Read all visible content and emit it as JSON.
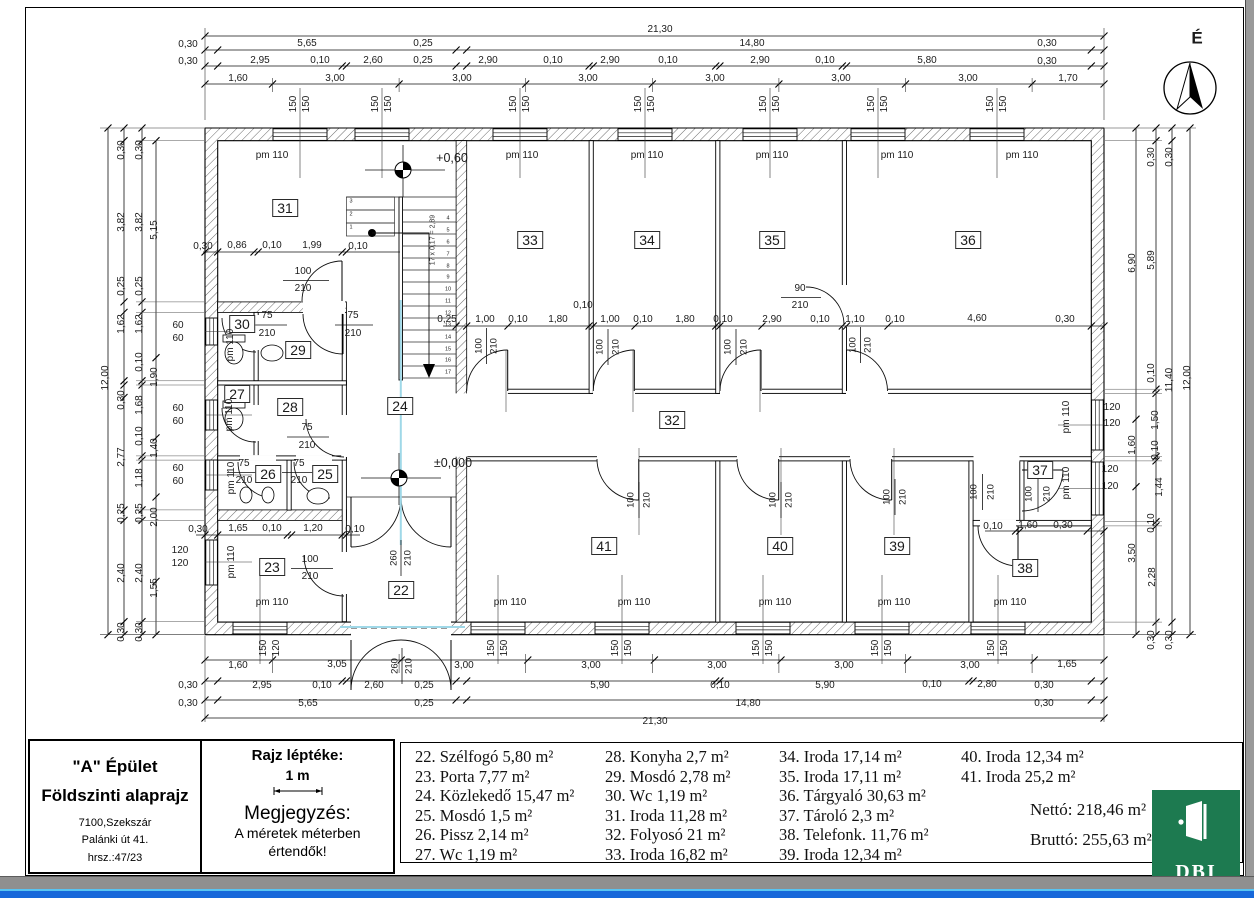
{
  "title_block": {
    "building": "\"A\" Épület",
    "drawing": "Földszinti alaprajz",
    "address_line1": "7100,Szekszár",
    "address_line2": "Palánki út 41.",
    "address_line3": "hrsz.:47/23"
  },
  "scale_block": {
    "label": "Rajz léptéke:",
    "scale": "1 m",
    "note_title": "Megjegyzés:",
    "note_line1": "A méretek méterben",
    "note_line2": "értendők!"
  },
  "legend": {
    "columns": [
      [
        "22. Szélfogó 5,80 m²",
        "23. Porta 7,77 m²",
        "24. Közlekedő 15,47 m²",
        "25. Mosdó 1,5 m²",
        "26. Pissz 2,14 m²",
        "27. Wc 1,19 m²"
      ],
      [
        "28. Konyha 2,7 m²",
        "29. Mosdó 2,78 m²",
        "30. Wc 1,19 m²",
        "31. Iroda 11,28 m²",
        "32. Folyosó 21 m²",
        "33. Iroda 16,82 m²"
      ],
      [
        "34. Iroda 17,14 m²",
        "35. Iroda 17,11 m²",
        "36. Tárgyaló 30,63 m²",
        "37. Tároló 2,3 m²",
        "38. Telefonk. 11,76 m²",
        "39. Iroda 12,34 m²"
      ],
      [
        "40. Iroda 12,34 m²",
        "41. Iroda 25,2 m²"
      ]
    ]
  },
  "totals": {
    "net": "Nettó: 218,46 m²",
    "gross": "Bruttó: 255,63 m²"
  },
  "logo": {
    "text": "DBI"
  },
  "compass": {
    "label": "É"
  },
  "plan": {
    "rooms": [
      [
        "22",
        401,
        590
      ],
      [
        "23",
        272,
        567
      ],
      [
        "24",
        400,
        406
      ],
      [
        "25",
        325,
        474
      ],
      [
        "26",
        268,
        474
      ],
      [
        "27",
        237,
        394
      ],
      [
        "28",
        290,
        407
      ],
      [
        "29",
        298,
        350
      ],
      [
        "30",
        242,
        324
      ],
      [
        "31",
        285,
        208
      ],
      [
        "32",
        672,
        420
      ],
      [
        "33",
        530,
        240
      ],
      [
        "34",
        647,
        240
      ],
      [
        "35",
        772,
        240
      ],
      [
        "36",
        968,
        240
      ],
      [
        "37",
        1040,
        470
      ],
      [
        "38",
        1025,
        568
      ],
      [
        "39",
        897,
        546
      ],
      [
        "40",
        780,
        546
      ],
      [
        "41",
        604,
        546
      ]
    ],
    "pm_h": [
      [
        "pm 110",
        272,
        156
      ],
      [
        "pm 110",
        522,
        156
      ],
      [
        "pm 110",
        647,
        156
      ],
      [
        "pm 110",
        772,
        156
      ],
      [
        "pm 110",
        897,
        156
      ],
      [
        "pm 110",
        1022,
        156
      ],
      [
        "pm 110",
        272,
        603
      ],
      [
        "pm 110",
        510,
        603
      ],
      [
        "pm 110",
        634,
        603
      ],
      [
        "pm 110",
        775,
        603
      ],
      [
        "pm 110",
        894,
        603
      ],
      [
        "pm 110",
        1010,
        603
      ]
    ],
    "pm_v": [
      [
        "pm 110",
        231,
        345
      ],
      [
        "pm 110",
        230,
        415
      ],
      [
        "pm 110",
        232,
        478
      ],
      [
        "pm 110",
        232,
        562
      ],
      [
        "pm 110",
        1067,
        417
      ],
      [
        "pm 110",
        1067,
        483
      ]
    ],
    "levels": [
      [
        "+0,60",
        452,
        158
      ],
      [
        "±0,000",
        453,
        463
      ]
    ],
    "stair_note": [
      [
        "17 x 0,17 = 2,89",
        433,
        240
      ]
    ],
    "stair_numbers": [
      [
        "1",
        351,
        228
      ],
      [
        "2",
        351,
        215
      ],
      [
        "3",
        351,
        202
      ],
      [
        "4",
        448,
        219
      ],
      [
        "5",
        448,
        231
      ],
      [
        "6",
        448,
        243
      ],
      [
        "7",
        448,
        255
      ],
      [
        "8",
        448,
        267
      ],
      [
        "9",
        448,
        278
      ],
      [
        "10",
        448,
        290
      ],
      [
        "11",
        448,
        302
      ],
      [
        "12",
        448,
        314
      ],
      [
        "13",
        448,
        326
      ],
      [
        "14",
        448,
        338
      ],
      [
        "15",
        448,
        350
      ],
      [
        "16",
        448,
        361
      ],
      [
        "17",
        448,
        373
      ]
    ],
    "doors_h": [
      [
        "100",
        303,
        272
      ],
      [
        "210",
        303,
        289
      ],
      [
        "75",
        267,
        316
      ],
      [
        "210",
        267,
        334
      ],
      [
        "75",
        353,
        316
      ],
      [
        "210",
        353,
        334
      ],
      [
        "75",
        307,
        428
      ],
      [
        "210",
        307,
        446
      ],
      [
        "75",
        244,
        464
      ],
      [
        "210",
        244,
        481
      ],
      [
        "75",
        299,
        464
      ],
      [
        "210",
        299,
        481
      ],
      [
        "100",
        310,
        560
      ],
      [
        "210",
        310,
        577
      ],
      [
        "90",
        800,
        289
      ],
      [
        "210",
        800,
        306
      ]
    ],
    "doors_v": [
      [
        "100",
        479,
        346
      ],
      [
        "210",
        494,
        346
      ],
      [
        "100",
        600,
        347
      ],
      [
        "210",
        616,
        347
      ],
      [
        "100",
        728,
        347
      ],
      [
        "210",
        744,
        347
      ],
      [
        "100",
        853,
        345
      ],
      [
        "210",
        868,
        345
      ],
      [
        "100",
        631,
        500
      ],
      [
        "210",
        647,
        500
      ],
      [
        "100",
        773,
        500
      ],
      [
        "210",
        789,
        500
      ],
      [
        "100",
        887,
        497
      ],
      [
        "210",
        903,
        497
      ],
      [
        "100",
        974,
        492
      ],
      [
        "210",
        991,
        492
      ],
      [
        "100",
        1029,
        494
      ],
      [
        "210",
        1047,
        494
      ],
      [
        "260",
        394,
        558
      ],
      [
        "210",
        408,
        558
      ],
      [
        "260",
        395,
        666
      ],
      [
        "210",
        409,
        666
      ]
    ],
    "dims_h": [
      [
        "21,30",
        660,
        30
      ],
      [
        "0,30",
        188,
        45
      ],
      [
        "5,65",
        307,
        44
      ],
      [
        "0,25",
        423,
        44
      ],
      [
        "14,80",
        752,
        44
      ],
      [
        "0,30",
        1047,
        44
      ],
      [
        "0,30",
        188,
        62
      ],
      [
        "2,95",
        260,
        61
      ],
      [
        "0,10",
        320,
        61
      ],
      [
        "2,60",
        373,
        61
      ],
      [
        "0,25",
        423,
        61
      ],
      [
        "2,90",
        488,
        61
      ],
      [
        "0,10",
        553,
        61
      ],
      [
        "2,90",
        610,
        61
      ],
      [
        "0,10",
        668,
        61
      ],
      [
        "2,90",
        760,
        61
      ],
      [
        "0,10",
        825,
        61
      ],
      [
        "5,80",
        927,
        61
      ],
      [
        "0,30",
        1047,
        62
      ],
      [
        "1,60",
        238,
        79
      ],
      [
        "3,00",
        335,
        79
      ],
      [
        "3,00",
        462,
        79
      ],
      [
        "3,00",
        588,
        79
      ],
      [
        "3,00",
        715,
        79
      ],
      [
        "3,00",
        841,
        79
      ],
      [
        "3,00",
        968,
        79
      ],
      [
        "1,70",
        1068,
        79
      ],
      [
        "0,25",
        447,
        320
      ],
      [
        "1,00",
        485,
        320
      ],
      [
        "0,10",
        518,
        320
      ],
      [
        "1,80",
        558,
        320
      ],
      [
        "0,10",
        583,
        306
      ],
      [
        "1,00",
        610,
        320
      ],
      [
        "0,10",
        643,
        320
      ],
      [
        "1,80",
        685,
        320
      ],
      [
        "0,10",
        723,
        320
      ],
      [
        "2,90",
        772,
        320
      ],
      [
        "0,10",
        820,
        320
      ],
      [
        "1,10",
        855,
        320
      ],
      [
        "0,10",
        895,
        320
      ],
      [
        "4,60",
        977,
        319
      ],
      [
        "0,30",
        1065,
        320
      ],
      [
        "0,30",
        203,
        247
      ],
      [
        "0,86",
        237,
        246
      ],
      [
        "0,10",
        272,
        246
      ],
      [
        "1,99",
        312,
        246
      ],
      [
        "0,10",
        358,
        247
      ],
      [
        "0,30",
        198,
        530
      ],
      [
        "1,65",
        238,
        529
      ],
      [
        "0,10",
        272,
        529
      ],
      [
        "1,20",
        313,
        529
      ],
      [
        "0,10",
        355,
        530
      ],
      [
        "0,10",
        993,
        527
      ],
      [
        "1,60",
        1028,
        526
      ],
      [
        "0,30",
        1063,
        526
      ],
      [
        "60",
        178,
        326
      ],
      [
        "60",
        178,
        339
      ],
      [
        "60",
        178,
        409
      ],
      [
        "60",
        178,
        422
      ],
      [
        "60",
        178,
        469
      ],
      [
        "60",
        178,
        482
      ],
      [
        "120",
        180,
        551
      ],
      [
        "120",
        180,
        564
      ],
      [
        "120",
        1112,
        408
      ],
      [
        "120",
        1112,
        424
      ],
      [
        "120",
        1110,
        470
      ],
      [
        "120",
        1110,
        487
      ],
      [
        "1,60",
        238,
        666
      ],
      [
        "3,05",
        337,
        665
      ],
      [
        "3,00",
        464,
        666
      ],
      [
        "3,00",
        591,
        666
      ],
      [
        "3,00",
        717,
        666
      ],
      [
        "3,00",
        844,
        666
      ],
      [
        "3,00",
        970,
        666
      ],
      [
        "1,65",
        1067,
        665
      ],
      [
        "0,30",
        188,
        686
      ],
      [
        "2,95",
        262,
        686
      ],
      [
        "0,10",
        322,
        686
      ],
      [
        "2,60",
        374,
        686
      ],
      [
        "0,25",
        424,
        686
      ],
      [
        "5,90",
        600,
        686
      ],
      [
        "0,10",
        720,
        686
      ],
      [
        "5,90",
        825,
        686
      ],
      [
        "0,10",
        932,
        685
      ],
      [
        "2,80",
        987,
        685
      ],
      [
        "0,30",
        1044,
        686
      ],
      [
        "0,30",
        188,
        704
      ],
      [
        "5,65",
        308,
        704
      ],
      [
        "0,25",
        424,
        704
      ],
      [
        "14,80",
        748,
        704
      ],
      [
        "0,30",
        1044,
        704
      ],
      [
        "21,30",
        655,
        722
      ]
    ],
    "dims_v": [
      [
        "12,00",
        106,
        378
      ],
      [
        "0,30",
        122,
        150
      ],
      [
        "3,82",
        122,
        222
      ],
      [
        "0,25",
        122,
        286
      ],
      [
        "1,62",
        122,
        324
      ],
      [
        "0,30",
        122,
        400
      ],
      [
        "2,77",
        122,
        457
      ],
      [
        "0,25",
        122,
        513
      ],
      [
        "2,40",
        122,
        573
      ],
      [
        "0,30",
        122,
        632
      ],
      [
        "0,30",
        140,
        150
      ],
      [
        "3,82",
        140,
        222
      ],
      [
        "0,25",
        140,
        286
      ],
      [
        "1,62",
        140,
        324
      ],
      [
        "0,10",
        140,
        362
      ],
      [
        "1,68",
        140,
        405
      ],
      [
        "0,10",
        140,
        436
      ],
      [
        "1,18",
        140,
        478
      ],
      [
        "0,25",
        140,
        513
      ],
      [
        "2,40",
        140,
        573
      ],
      [
        "0,30",
        140,
        632
      ],
      [
        "5,15",
        155,
        230
      ],
      [
        "1,90",
        155,
        377
      ],
      [
        "1,40",
        155,
        448
      ],
      [
        "2,00",
        155,
        517
      ],
      [
        "1,55",
        155,
        588
      ],
      [
        "6,90",
        1133,
        263
      ],
      [
        "1,60",
        1133,
        445
      ],
      [
        "3,50",
        1133,
        553
      ],
      [
        "0,30",
        1152,
        157
      ],
      [
        "5,89",
        1152,
        260
      ],
      [
        "0,10",
        1152,
        373
      ],
      [
        "1,50",
        1156,
        420
      ],
      [
        "0,10",
        1156,
        450
      ],
      [
        "1,44",
        1160,
        487
      ],
      [
        "0,10",
        1152,
        523
      ],
      [
        "2,28",
        1153,
        577
      ],
      [
        "0,30",
        1152,
        640
      ],
      [
        "0,30",
        1170,
        157
      ],
      [
        "11,40",
        1170,
        380
      ],
      [
        "0,30",
        1170,
        640
      ],
      [
        "12,00",
        1188,
        378
      ],
      [
        "150",
        294,
        104
      ],
      [
        "150",
        307,
        104
      ],
      [
        "150",
        376,
        104
      ],
      [
        "150",
        389,
        104
      ],
      [
        "150",
        514,
        104
      ],
      [
        "150",
        527,
        104
      ],
      [
        "150",
        639,
        104
      ],
      [
        "150",
        652,
        104
      ],
      [
        "150",
        764,
        104
      ],
      [
        "150",
        777,
        104
      ],
      [
        "150",
        872,
        104
      ],
      [
        "150",
        885,
        104
      ],
      [
        "150",
        991,
        104
      ],
      [
        "150",
        1004,
        104
      ],
      [
        "150",
        264,
        648
      ],
      [
        "120",
        277,
        648
      ],
      [
        "150",
        492,
        648
      ],
      [
        "150",
        505,
        648
      ],
      [
        "150",
        616,
        648
      ],
      [
        "150",
        629,
        648
      ],
      [
        "150",
        757,
        648
      ],
      [
        "150",
        770,
        648
      ],
      [
        "150",
        876,
        648
      ],
      [
        "150",
        889,
        648
      ],
      [
        "150",
        992,
        648
      ],
      [
        "150",
        1005,
        648
      ]
    ]
  }
}
